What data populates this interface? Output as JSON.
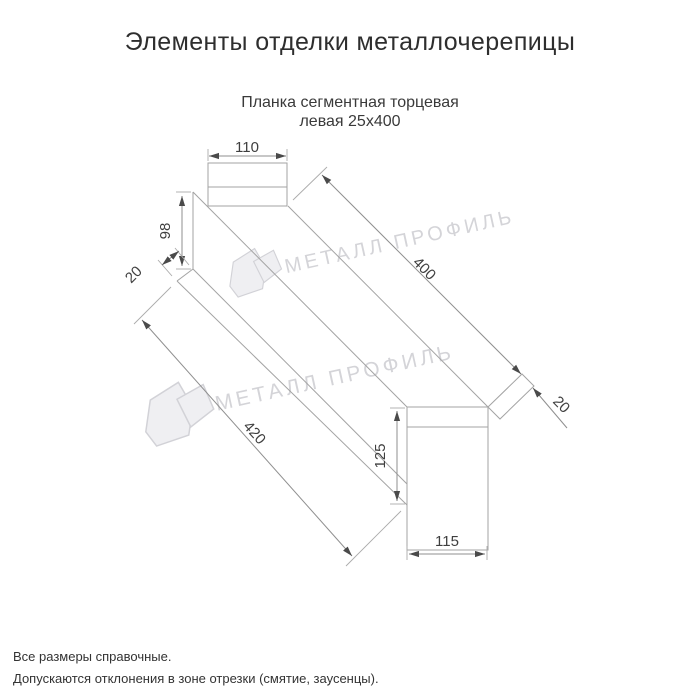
{
  "title": "Элементы отделки металлочерепицы",
  "subtitle": {
    "line1": "Планка сегментная торцевая",
    "line2": "левая 25x400"
  },
  "drawing": {
    "dimensions": {
      "top_face_width": "110",
      "left_end_height": "98",
      "left_flange": "20",
      "top_edge_length": "400",
      "bottom_edge_length": "420",
      "right_end_height": "125",
      "right_end_width": "115",
      "right_flange": "20"
    }
  },
  "watermark": {
    "text": "МЕТАЛЛ ПРОФИЛЬ"
  },
  "footer": {
    "note1": "Все размеры справочные.",
    "note2": "Допускаются отклонения в зоне отрезки (смятие, заусенцы)."
  },
  "colors": {
    "background": "#ffffff",
    "line": "#a3a3a3",
    "dim_text": "#3f3f3f",
    "title_text": "#2e2e2e",
    "watermark": "#d4d4d8"
  }
}
